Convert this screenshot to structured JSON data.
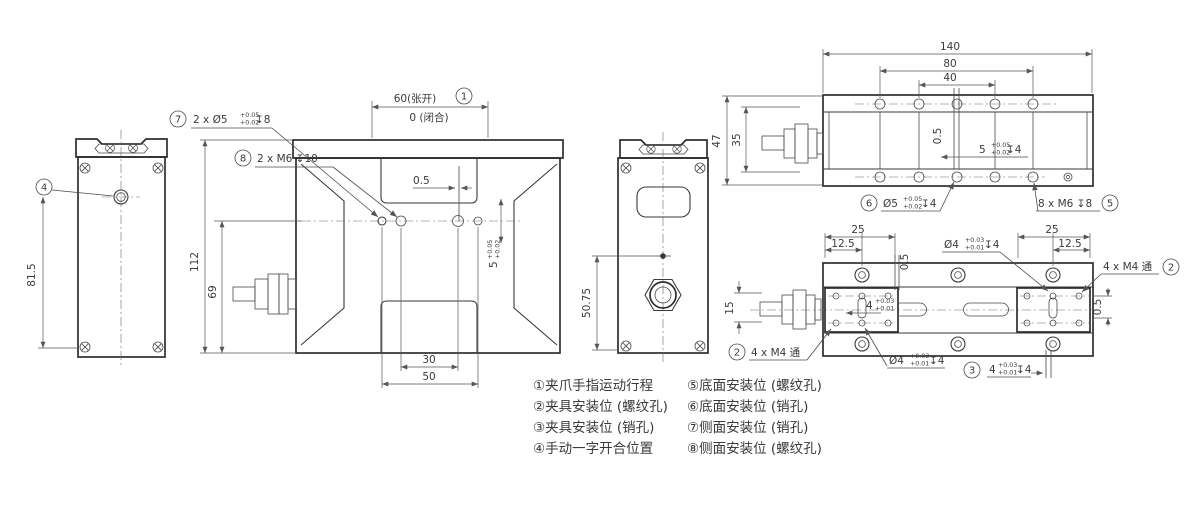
{
  "colors": {
    "line": "#333333",
    "text": "#3a3a3a",
    "background": "#ffffff"
  },
  "left_view": {
    "callout": "4",
    "dim_height": "81.5"
  },
  "front_view": {
    "callout_stroke": "1",
    "stroke_open": "60(张开)",
    "stroke_closed": "0 (闭合)",
    "callout_pin": "7",
    "pin_label": "2 x  Ø5",
    "pin_tol_up": "+0.05",
    "pin_tol_dn": "+0.02",
    "pin_depth": "↧8",
    "callout_thread": "8",
    "thread_label": "2 x M6 ↧10",
    "dim_offset": "0.5",
    "dim_pitch": "5",
    "pitch_tol_up": "+0.05",
    "pitch_tol_dn": "+0.02",
    "dim_30": "30",
    "dim_50": "50",
    "dim_112": "112",
    "dim_69": "69"
  },
  "end_view": {
    "dim_height": "50.75"
  },
  "side_view": {
    "dim_140": "140",
    "dim_80": "80",
    "dim_40": "40",
    "dim_47": "47",
    "dim_35": "35",
    "dim_offset": "0.5",
    "dim_pitch": "5",
    "pitch_tol_up": "+0.05",
    "pitch_tol_dn": "+0.02",
    "pitch_depth": "↧4",
    "callout_pin": "6",
    "pin_dia": "Ø5",
    "pin_tol_up": "+0.05",
    "pin_tol_dn": "+0.02",
    "pin_depth": "↧4",
    "thread_label": "8 x M6 ↧8",
    "callout_thread": "5"
  },
  "bottom_view": {
    "dim_25_left": "25",
    "dim_125_left": "12.5",
    "dim_05_left": "0.5",
    "dim_25_right": "25",
    "dim_125_right": "12.5",
    "dim_05_right": "0.5",
    "dim_15": "15",
    "pin_top_dia": "Ø4",
    "pin_top_tol_up": "+0.03",
    "pin_top_tol_dn": "+0.01",
    "pin_top_depth": "↧4",
    "pin_bot_dia": "Ø4",
    "pin_bot_tol_up": "+0.03",
    "pin_bot_tol_dn": "+0.01",
    "pin_bot_depth": "↧4",
    "thread_right": "4 x M4 通",
    "callout_thread_right": "2",
    "thread_left": "4 x M4 通",
    "callout_thread_left": "2",
    "callout_pin_dim": "3",
    "pin_dim": "4",
    "pin_dim_tol_up": "+0.03",
    "pin_dim_tol_dn": "+0.01",
    "pin_dim_depth": "↧4",
    "jaw_dim": "4",
    "jaw_tol_up": "+0.03",
    "jaw_tol_dn": "+0.01"
  },
  "legend": {
    "items_left": [
      "①夹爪手指运动行程",
      "②夹具安装位 (螺纹孔)",
      "③夹具安装位 (销孔)",
      "④手动一字开合位置"
    ],
    "items_right": [
      "⑤底面安装位 (螺纹孔)",
      "⑥底面安装位 (销孔)",
      "⑦侧面安装位 (销孔)",
      "⑧侧面安装位 (螺纹孔)"
    ]
  }
}
